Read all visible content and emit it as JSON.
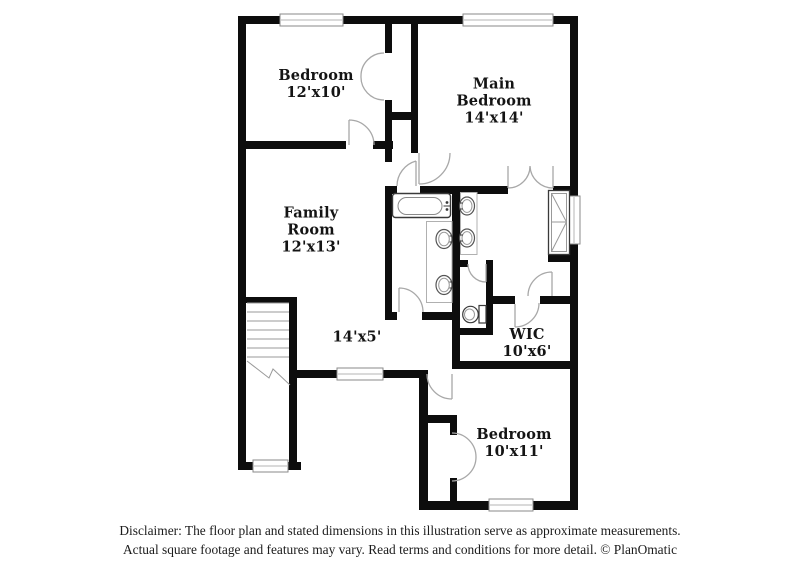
{
  "floor_plan": {
    "rooms": {
      "bedroom_top": {
        "name": "Bedroom",
        "dims": "12'x10'"
      },
      "main_bedroom": {
        "name_line1": "Main",
        "name_line2": "Bedroom",
        "dims": "14'x14'"
      },
      "family_room": {
        "name_line1": "Family",
        "name_line2": "Room",
        "dims": "12'x13'"
      },
      "hall": {
        "dims": "14'x5'"
      },
      "wic": {
        "name": "WIC",
        "dims": "10'x6'"
      },
      "bedroom_bottom": {
        "name": "Bedroom",
        "dims": "10'x11'"
      }
    },
    "fixtures": [
      "bathtub",
      "vanity-sinks",
      "toilet",
      "shower",
      "staircase"
    ],
    "colors": {
      "wall": "#0d0d0d",
      "door_swing": "#a8a8a8",
      "fixture_outline": "#3a3a3a"
    }
  },
  "footer": {
    "disclaimer_line1": "Disclaimer: The floor plan and stated dimensions in this illustration serve as approximate measurements.",
    "disclaimer_line2": "Actual square footage and features may vary. Read terms and conditions for more detail. © PlanOmatic"
  }
}
